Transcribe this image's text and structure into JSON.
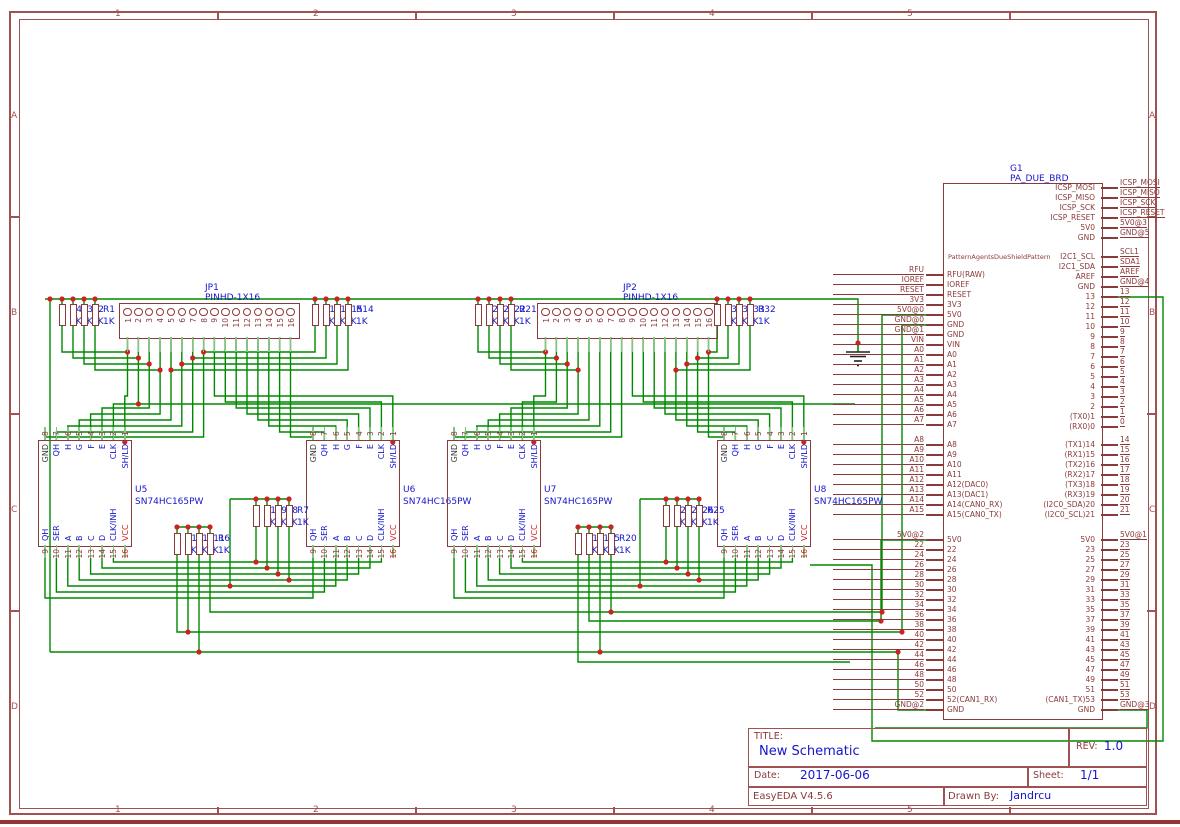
{
  "frame": {
    "columns": [
      "1",
      "2",
      "3",
      "4",
      "5"
    ],
    "rows": [
      "A",
      "B",
      "C",
      "D"
    ]
  },
  "title_block": {
    "title_label": "TITLE:",
    "title": "New Schematic",
    "rev_label": "REV:",
    "rev": "1.0",
    "date_label": "Date:",
    "date": "2017-06-06",
    "sheet_label": "Sheet:",
    "sheet": "1/1",
    "tool_version": "EasyEDA V4.5.6",
    "drawn_by_label": "Drawn By:",
    "drawn_by": "Jandrcu"
  },
  "headers": [
    {
      "refdes": "JP1",
      "part": "PINHD-1X16",
      "pins": [
        "1",
        "2",
        "3",
        "4",
        "5",
        "6",
        "7",
        "8",
        "9",
        "10",
        "11",
        "12",
        "13",
        "14",
        "15",
        "16"
      ]
    },
    {
      "refdes": "JP2",
      "part": "PINHD-1X16",
      "pins": [
        "1",
        "2",
        "3",
        "4",
        "5",
        "6",
        "7",
        "8",
        "9",
        "10",
        "11",
        "12",
        "13",
        "14",
        "15",
        "16"
      ]
    }
  ],
  "ic_pins": {
    "top": [
      {
        "num": "8",
        "name": "GND",
        "c": "gnd"
      },
      {
        "num": "7",
        "name": "QH",
        "c": "blue"
      },
      {
        "num": "6",
        "name": "H",
        "c": "blue"
      },
      {
        "num": "5",
        "name": "G",
        "c": "blue"
      },
      {
        "num": "4",
        "name": "F",
        "c": "blue"
      },
      {
        "num": "3",
        "name": "E",
        "c": "blue"
      },
      {
        "num": "2",
        "name": "CLK",
        "c": "blue"
      },
      {
        "num": "1",
        "name": "SH/LD",
        "c": "blue"
      }
    ],
    "bottom": [
      {
        "num": "9",
        "name": "QH",
        "c": "blue"
      },
      {
        "num": "10",
        "name": "SER",
        "c": "blue"
      },
      {
        "num": "11",
        "name": "A",
        "c": "blue"
      },
      {
        "num": "12",
        "name": "B",
        "c": "blue"
      },
      {
        "num": "13",
        "name": "C",
        "c": "blue"
      },
      {
        "num": "14",
        "name": "D",
        "c": "blue"
      },
      {
        "num": "15",
        "name": "CLK/INH",
        "c": "blue"
      },
      {
        "num": "16",
        "name": "VCC",
        "c": "red",
        "numc": "red"
      }
    ]
  },
  "ics": [
    {
      "refdes": "U5",
      "part": "SN74HC165PW"
    },
    {
      "refdes": "U6",
      "part": "SN74HC165PW"
    },
    {
      "refdes": "U7",
      "part": "SN74HC165PW"
    },
    {
      "refdes": "U8",
      "part": "SN74HC165PW"
    }
  ],
  "resistor_groups": [
    {
      "refs": [
        "R4",
        "R3",
        "R2",
        "R1"
      ],
      "values": [
        "1K",
        "1K",
        "1K",
        "1K"
      ]
    },
    {
      "refs": [
        "R17",
        "R16",
        "R15",
        "R14"
      ],
      "values": [
        "1K",
        "1K",
        "1K",
        "1K"
      ]
    },
    {
      "refs": [
        "R24",
        "R23",
        "R22",
        "R21"
      ],
      "values": [
        "1K",
        "1K",
        "1K",
        "1K"
      ]
    },
    {
      "refs": [
        "R35",
        "R34",
        "R33",
        "R32"
      ],
      "values": [
        "1K",
        "1K",
        "1K",
        "1K"
      ]
    },
    {
      "refs": [
        "R10",
        "R9",
        "R8",
        "R7"
      ],
      "values": [
        "1K",
        "1K",
        "1K",
        "1K"
      ]
    },
    {
      "refs": [
        "R13",
        "R12",
        "R11",
        "R6"
      ],
      "values": [
        "1K",
        "1K",
        "1K",
        "1K"
      ]
    },
    {
      "refs": [
        "R28",
        "R27",
        "R26",
        "R25"
      ],
      "values": [
        "1K",
        "1K",
        "1K",
        "1K"
      ]
    },
    {
      "refs": [
        "R19",
        "R18",
        "R5",
        "R20"
      ],
      "values": [
        "1K",
        "1K",
        "1K",
        "1K"
      ]
    }
  ],
  "due_board": {
    "refdes": "G1",
    "part": "PA_DUE_BRD",
    "watermark": "PatternAgentsDueShieldPattern",
    "left_blocks": [
      [
        [
          "RFU",
          "RFU(RAW)"
        ],
        [
          "IOREF",
          "IOREF"
        ],
        [
          "RESET",
          "RESET"
        ],
        [
          "3V3",
          "3V3"
        ],
        [
          "5V0@0",
          "5V0"
        ],
        [
          "GND@0",
          "GND"
        ],
        [
          "GND@1",
          "GND"
        ],
        [
          "VIN",
          "VIN"
        ],
        [
          "A0",
          "A0"
        ],
        [
          "A1",
          "A1"
        ],
        [
          "A2",
          "A2"
        ],
        [
          "A3",
          "A3"
        ],
        [
          "A4",
          "A4"
        ],
        [
          "A5",
          "A5"
        ],
        [
          "A6",
          "A6"
        ],
        [
          "A7",
          "A7"
        ]
      ],
      [
        [
          "A8",
          "A8"
        ],
        [
          "A9",
          "A9"
        ],
        [
          "A10",
          "A10"
        ],
        [
          "A11",
          "A11"
        ],
        [
          "A12",
          "A12(DAC0)"
        ],
        [
          "A13",
          "A13(DAC1)"
        ],
        [
          "A14",
          "A14(CAN0_RX)"
        ],
        [
          "A15",
          "A15(CAN0_TX)"
        ]
      ],
      [
        [
          "5V0@2",
          "5V0"
        ],
        [
          "22",
          "22"
        ],
        [
          "24",
          "24"
        ],
        [
          "26",
          "26"
        ],
        [
          "28",
          "28"
        ],
        [
          "30",
          "30"
        ],
        [
          "32",
          "32"
        ],
        [
          "34",
          "34"
        ],
        [
          "36",
          "36"
        ],
        [
          "38",
          "38"
        ],
        [
          "40",
          "40"
        ],
        [
          "42",
          "42"
        ],
        [
          "44",
          "44"
        ],
        [
          "46",
          "46"
        ],
        [
          "48",
          "48"
        ],
        [
          "50",
          "50"
        ],
        [
          "52",
          "52(CAN1_RX)"
        ],
        [
          "GND@2",
          "GND"
        ]
      ]
    ],
    "right_blocks": [
      [
        [
          "ICSP_MOSI",
          "ICSP_MOSI"
        ],
        [
          "ICSP_MISO",
          "ICSP_MISO"
        ],
        [
          "ICSP_SCK",
          "ICSP_SCK"
        ],
        [
          "ICSP_RESET",
          "ICSP_RESET"
        ],
        [
          "5V0@3",
          "5V0"
        ],
        [
          "GND@5",
          "GND"
        ]
      ],
      [
        [
          "SCL1",
          "I2C1_SCL"
        ],
        [
          "SDA1",
          "I2C1_SDA"
        ],
        [
          "AREF",
          "AREF"
        ],
        [
          "GND@4",
          "GND"
        ],
        [
          "13",
          "13"
        ],
        [
          "12",
          "12"
        ],
        [
          "11",
          "11"
        ],
        [
          "10",
          "10"
        ],
        [
          "9",
          "9"
        ],
        [
          "8",
          "8"
        ],
        [
          "7",
          "7"
        ],
        [
          "6",
          "6"
        ],
        [
          "5",
          "5"
        ],
        [
          "4",
          "4"
        ],
        [
          "3",
          "3"
        ],
        [
          "2",
          "2"
        ],
        [
          "1",
          "(TX0)1"
        ],
        [
          "0",
          "(RX0)0"
        ]
      ],
      [
        [
          "14",
          "(TX1)14"
        ],
        [
          "15",
          "(RX1)15"
        ],
        [
          "16",
          "(TX2)16"
        ],
        [
          "17",
          "(RX2)17"
        ],
        [
          "18",
          "(TX3)18"
        ],
        [
          "19",
          "(RX3)19"
        ],
        [
          "20",
          "(I2C0_SDA)20"
        ],
        [
          "21",
          "(I2C0_SCL)21"
        ]
      ],
      [
        [
          "5V0@1",
          "5V0"
        ],
        [
          "23",
          "23"
        ],
        [
          "25",
          "25"
        ],
        [
          "27",
          "27"
        ],
        [
          "29",
          "29"
        ],
        [
          "31",
          "31"
        ],
        [
          "33",
          "33"
        ],
        [
          "35",
          "35"
        ],
        [
          "37",
          "37"
        ],
        [
          "39",
          "39"
        ],
        [
          "41",
          "41"
        ],
        [
          "43",
          "43"
        ],
        [
          "45",
          "45"
        ],
        [
          "47",
          "47"
        ],
        [
          "49",
          "49"
        ],
        [
          "51",
          "51"
        ],
        [
          "53",
          "(CAN1_TX)53"
        ],
        [
          "GND@3",
          "GND"
        ]
      ]
    ]
  },
  "colors": {
    "wire_green": "#008800",
    "junction_red": "#cc2222",
    "component_maroon": "#8b3a3a",
    "frame_maroon": "#a05252",
    "label_blue": "#1515cc",
    "gnd_text": "#3a3a3a"
  }
}
